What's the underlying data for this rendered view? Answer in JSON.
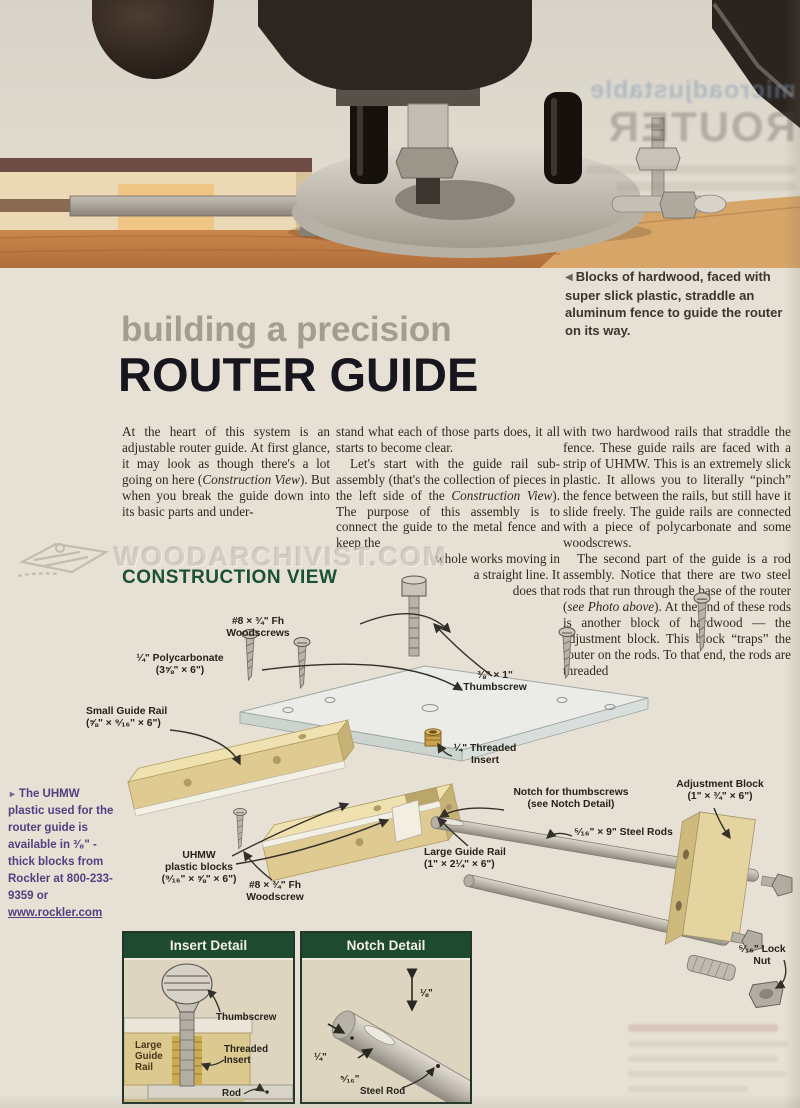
{
  "bleedthrough": {
    "line1": "microadjustable",
    "line2": "ROUTER"
  },
  "caption": {
    "marker": "◀",
    "text": "Blocks of hardwood, faced with super slick plastic, straddle an aluminum fence to guide the router on its way."
  },
  "title": {
    "kicker": "building a precision",
    "main": "ROUTER GUIDE"
  },
  "article": {
    "col1": {
      "pre": "At the heart of this system is an adjustable router guide. At first glance, it may look as though there's a lot going on here (",
      "italic": "Construction View",
      "post": "). But when you break the guide down into its basic parts and under-"
    },
    "col2_p1": "stand what each of those parts does, it all starts to become clear.",
    "col2_p2": {
      "pre": "Let's start with the guide rail sub-assembly (that's the collection of pieces in the left side of the ",
      "italic": "Construction View",
      "post": "). The purpose of this assembly is to connect the guide to the metal fence and keep the"
    },
    "col2_wrap": [
      "whole works moving in",
      "a straight line. It",
      "does that"
    ],
    "col3_p1": "with two hardwood rails that straddle the fence. These guide rails are faced with a strip of UHMW. This is an extremely slick plastic. It allows you to literally “pinch” the fence between the rails, but still have it slide freely. The guide rails are connected with a piece of polycarbonate and some woodscrews.",
    "col3_p2": {
      "pre": "The second part of the guide is a rod assembly. Notice that there are two steel rods that run through the base of the router (",
      "italic": "see Photo above",
      "post": "). At the end of these rods is another block of hardwood — the adjustment block. This block “traps” the router on the rods. To that end, the rods are threaded"
    }
  },
  "watermark": {
    "text": "WOODARCHIVIST.COM"
  },
  "construction": {
    "heading": "CONSTRUCTION VIEW",
    "labels": [
      {
        "text": "#8 × ¾\" Fh\nWoodscrews"
      },
      {
        "text": "¼\" Polycarbonate\n(3⅝\" × 6\")"
      },
      {
        "text": "⅜\" × 1\"\nThumbscrew"
      },
      {
        "text": "¼\" Threaded\nInsert"
      },
      {
        "text": "Small Guide Rail\n(⅝\" × ⁹⁄₁₆\" × 6\")"
      },
      {
        "text": "UHMW\nplastic blocks\n(⁹⁄₁₆\" × ⅝\" × 6\")"
      },
      {
        "text": "#8 × ¾\" Fh\nWoodscrew"
      },
      {
        "text": "Large Guide Rail\n(1\" × 2¼\" × 6\")"
      },
      {
        "text": "Notch for thumbscrews\n(see Notch Detail)"
      },
      {
        "text": "⁵⁄₁₆\" × 9\" Steel Rods"
      },
      {
        "text": "Adjustment Block\n(1\" × ¾\" × 6\")"
      },
      {
        "text": "⁵⁄₁₆\" Lock\nNut"
      }
    ]
  },
  "sidebar": {
    "marker": "►",
    "text": "The UHMW plastic used for the router guide is available in ³⁄₈\" - thick blocks from Rockler at 800-233-9359 or ",
    "link": "www.rockler.com"
  },
  "details": {
    "insert": {
      "title": "Insert Detail",
      "thumbscrew": "Thumbscrew",
      "block": "Large\nGuide\nRail",
      "insert": "Threaded\nInsert",
      "rod": "Rod"
    },
    "notch": {
      "title": "Notch Detail",
      "dim_eighth": "⅛\"",
      "dim_quarter": "¼\"",
      "dim_sixteenth": "⁵⁄₁₆\"",
      "rod": "Steel Rod"
    }
  }
}
